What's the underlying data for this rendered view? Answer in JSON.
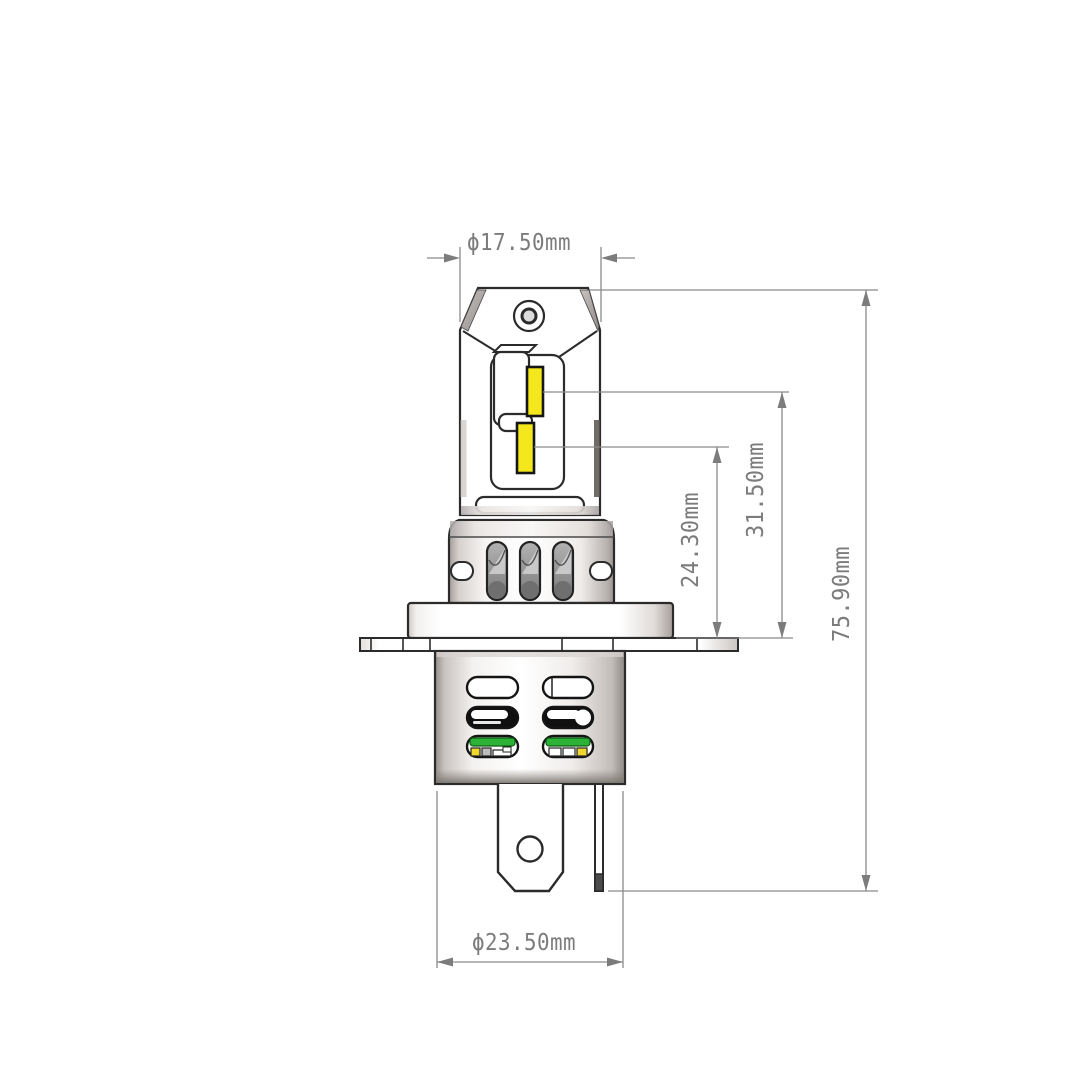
{
  "drawing": {
    "dimensions": {
      "cap_diameter": "ϕ17.50mm",
      "upper_led_center_height": "31.50mm",
      "lower_led_center_height": "24.30mm",
      "overall_height": "75.90mm",
      "base_diameter": "ϕ23.50mm"
    },
    "colors": {
      "outline": "#2b2b2b",
      "dimension_gray": "#7c7c7c",
      "led_yellow": "#f4e81c",
      "pcb_green": "#2cb236"
    }
  }
}
